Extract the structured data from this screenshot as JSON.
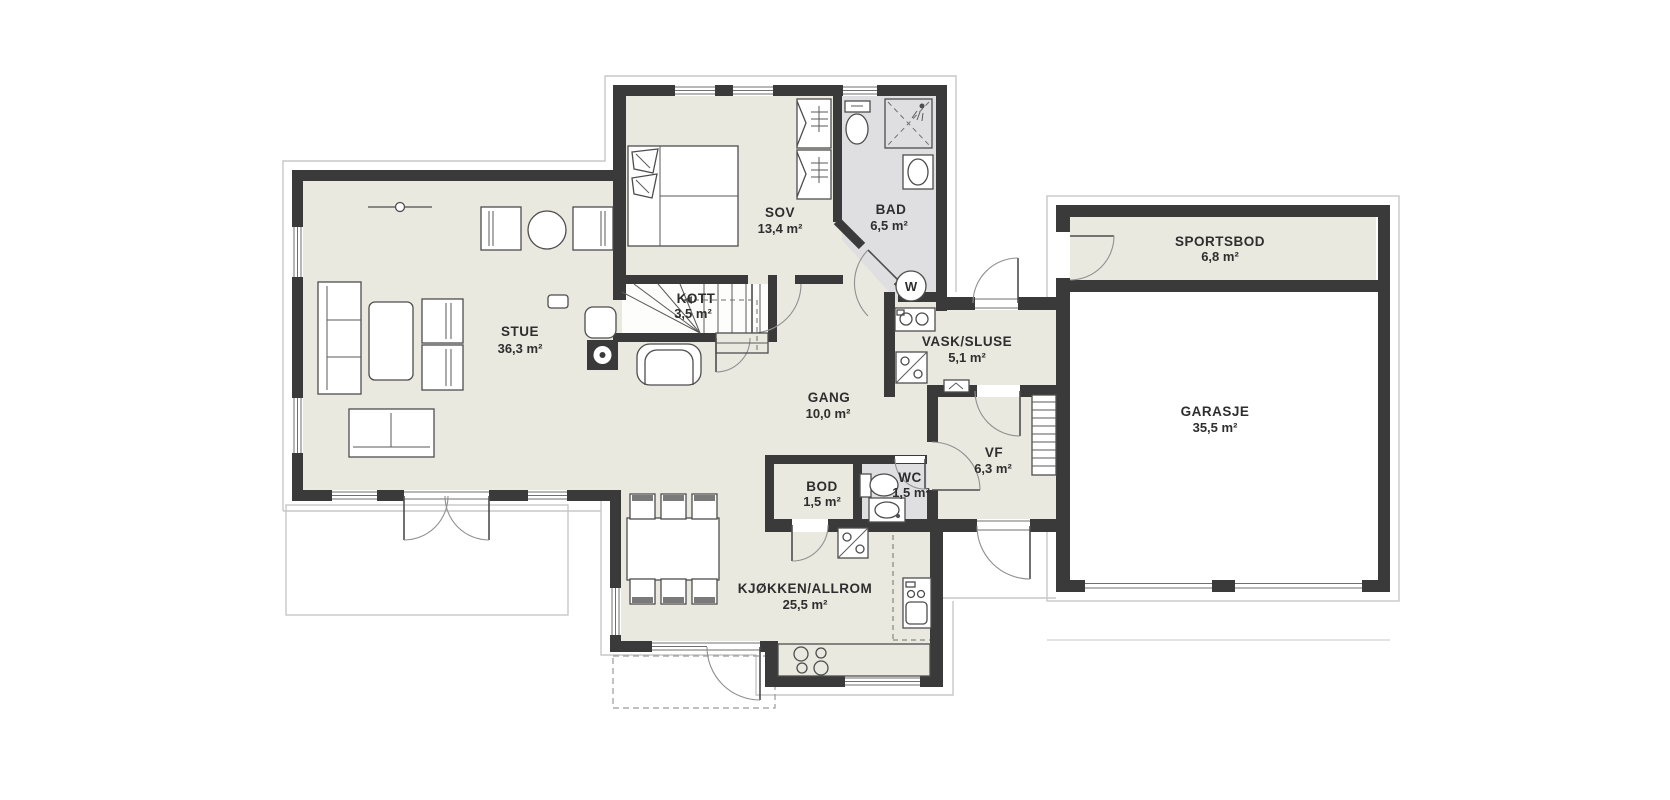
{
  "plan": {
    "type": "floorplan",
    "language": "Norwegian",
    "colors": {
      "wall": "#3a3a3a",
      "floor_main": "#eae9e0",
      "floor_wet": "#dfdfe2",
      "floor_garage": "#ffffff",
      "eaves_line": "#c7c7c7",
      "background": "#ffffff"
    },
    "rooms": [
      {
        "id": "stue",
        "name": "STUE",
        "area": "36,3 m²"
      },
      {
        "id": "sov",
        "name": "SOV",
        "area": "13,4 m²"
      },
      {
        "id": "bad",
        "name": "BAD",
        "area": "6,5 m²"
      },
      {
        "id": "kott",
        "name": "KOTT",
        "area": "3,5 m²"
      },
      {
        "id": "gang",
        "name": "GANG",
        "area": "10,0 m²"
      },
      {
        "id": "vask",
        "name": "VASK/SLUSE",
        "area": "5,1 m²"
      },
      {
        "id": "vf",
        "name": "VF",
        "area": "6,3 m²"
      },
      {
        "id": "wc",
        "name": "WC",
        "area": "1,5 m²"
      },
      {
        "id": "bod",
        "name": "BOD",
        "area": "1,5 m²"
      },
      {
        "id": "kjokken",
        "name": "KJØKKEN/ALLROM",
        "area": "25,5 m²"
      },
      {
        "id": "sportsbod",
        "name": "SPORTSBOD",
        "area": "6,8 m²"
      },
      {
        "id": "garasje",
        "name": "GARASJE",
        "area": "35,5 m²"
      }
    ],
    "symbols": {
      "water_heater": "W"
    }
  }
}
